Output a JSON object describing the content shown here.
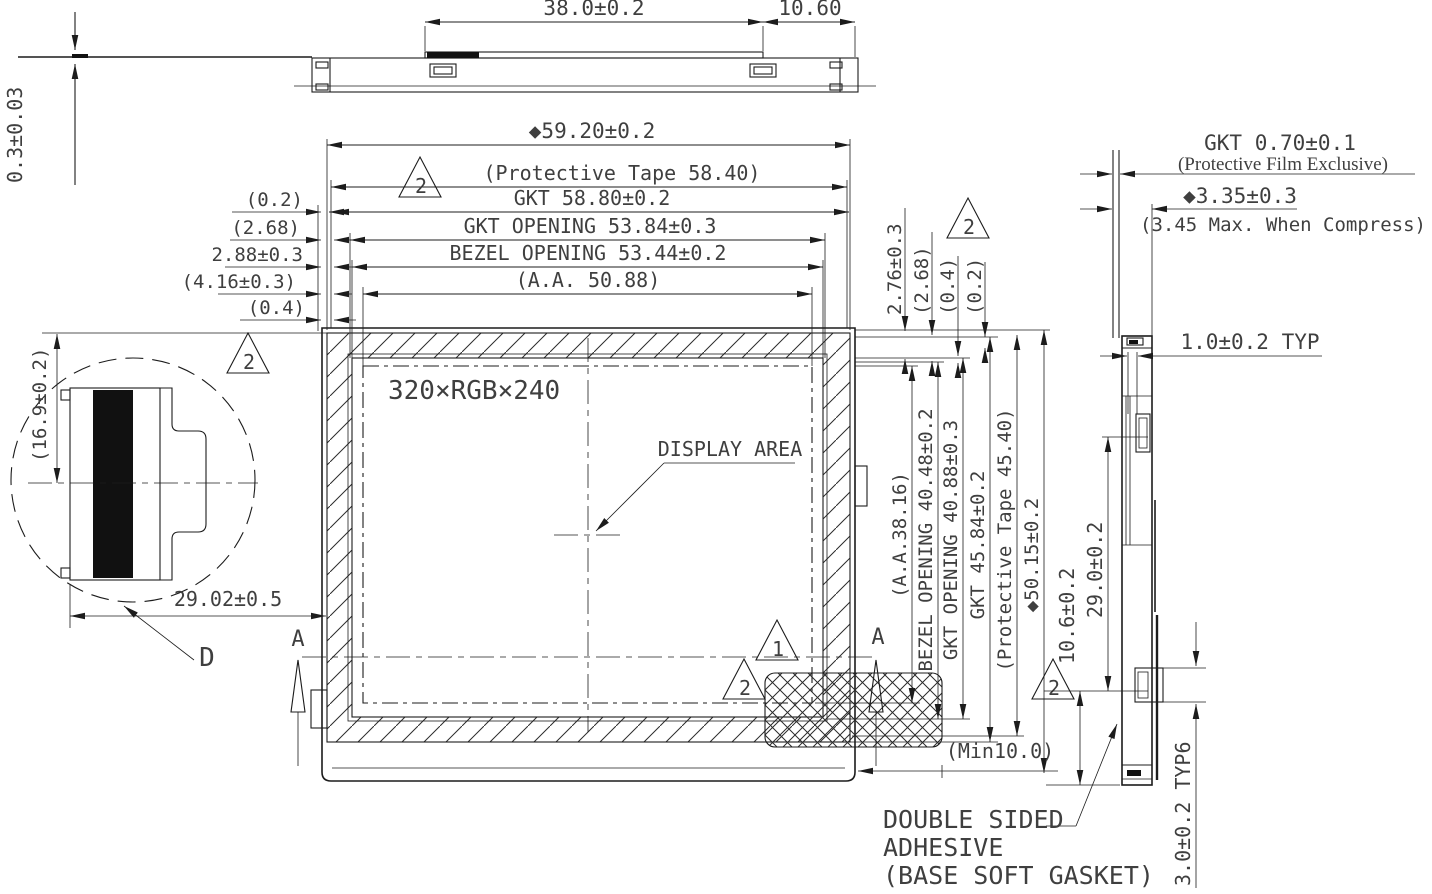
{
  "top_view": {
    "dim_width_center": "38.0±0.2",
    "dim_width_right": "10.60",
    "dim_film": "0.3±0.03"
  },
  "front_view": {
    "dim_total_width": "◆59.20±0.2",
    "dim_tape_width": "(Protective Tape 58.40)",
    "dim_gkt_width": "GKT 58.80±0.2",
    "dim_gkt_opening": "GKT OPENING 53.84±0.3",
    "dim_bezel_opening": "BEZEL OPENING 53.44±0.2",
    "dim_aa_width": "(A.A. 50.88)",
    "dim_left_1": "(0.2)",
    "dim_left_2": "(2.68)",
    "dim_left_3": "2.88±0.3",
    "dim_left_4": "(4.16±0.3)",
    "dim_left_5": "(0.4)",
    "resolution": "320×RGB×240",
    "display_area": "DISPLAY AREA",
    "dim_top_right_1": "2.76±0.3",
    "dim_top_right_2": "(2.68)",
    "dim_top_right_3": "(0.4)",
    "dim_top_right_4": "(0.2)",
    "dim_v_aa": "(A.A.38.16)",
    "dim_v_bezel": "BEZEL OPENING 40.48±0.2",
    "dim_v_gkt_opening": "GKT OPENING 40.88±0.3",
    "dim_v_gkt": "GKT 45.84±0.2",
    "dim_v_tape": "(Protective Tape 45.40)",
    "dim_v_total": "◆50.15±0.2",
    "dim_min": "(Min10.0)",
    "section_a": "A"
  },
  "detail_view": {
    "dim_height": "(16.9±0.2)",
    "dim_width": "29.02±0.5",
    "label": "D"
  },
  "side_view": {
    "dim_gkt_thickness": "GKT 0.70±0.1",
    "note_film": "(Protective Film Exclusive)",
    "dim_total_thickness": "◆3.35±0.3",
    "note_compress": "(3.45 Max. When Compress)",
    "dim_wall": "1.0±0.2 TYP",
    "dim_height_29": "29.0±0.2",
    "dim_height_10_6": "10.6±0.2",
    "dim_tab": "3.0±0.2 TYP6",
    "adhesive_line_1": "DOUBLE SIDED",
    "adhesive_line_2": "ADHESIVE",
    "adhesive_line_3": "(BASE SOFT GASKET)"
  },
  "flags": {
    "rev1": "1",
    "rev2": "2"
  }
}
